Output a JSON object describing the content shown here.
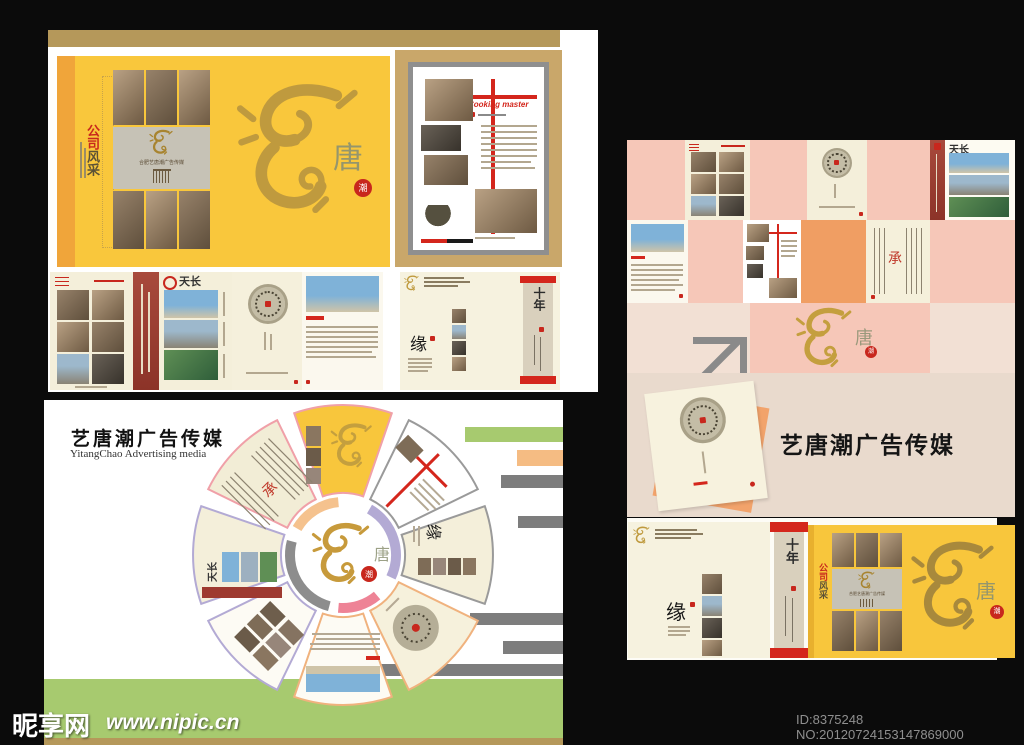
{
  "brand": {
    "name_cn": "艺唐潮广告传媒",
    "name_en": "YitangChao Advertising media",
    "logo_line": "合肥艺唐潮广告传媒"
  },
  "cover": {
    "tagline_red": "公司",
    "tagline_dark": "风采",
    "dragon_char": "唐",
    "seal_char": "潮"
  },
  "pages": {
    "cooking_title": "Cooking master",
    "tianchang": "天长",
    "yuan": "缘",
    "shinian": "十年",
    "cheng": "承"
  },
  "watermark": {
    "site": "昵享网",
    "url": "www.nipic.cn",
    "id": "ID:8375248 NO:20120724153147869000"
  },
  "colors": {
    "yellow": "#f8c63c",
    "gold": "#bf9a3e",
    "accent_red": "#c8271d",
    "maroon": "#9e3a30",
    "pink": "#f6c7b8",
    "orange": "#f09e63",
    "cream": "#f4efda",
    "beige": "#e9dacd",
    "tan": "#b5985a",
    "green": "#a7ca6f",
    "lavender": "#b3aad4",
    "gray": "#8a8a8a"
  }
}
